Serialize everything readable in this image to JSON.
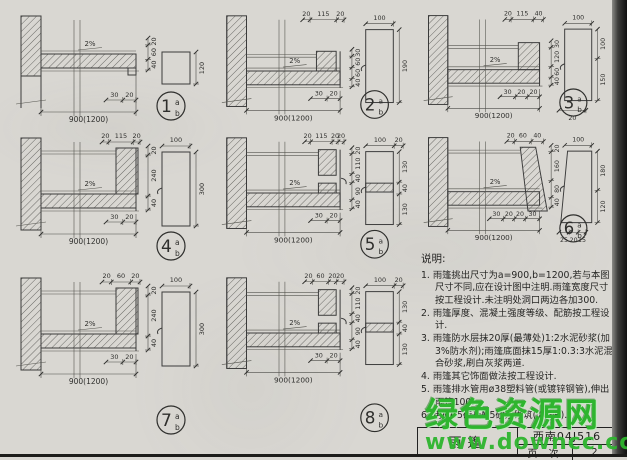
{
  "page": {
    "watermark": {
      "line1": "绿色资源网",
      "line2": "www.downcc.com",
      "color": "#2eb52e"
    },
    "title_block": {
      "drawing_title": "雨篷",
      "atlas_code": "西南04J516",
      "page_label": "页 次",
      "page_number": "2"
    }
  },
  "notes": {
    "heading": "说明:",
    "items": [
      {
        "text": "1. 雨篷挑出尺寸为a=900,b=1200,若与本图尺寸不同,应在设计图中注明.雨篷宽度尺寸按工程设计.未注明处洞口两边各加300."
      },
      {
        "text": "2. 雨篷厚度、混凝土强度等级、配筋按工程设计."
      },
      {
        "text": "3. 雨篷防水层抹20厚(最薄处)1:2水泥砂浆(加3%防水剂);雨篷底面抹15厚1:0.3:3水泥混合砂浆,刷白灰浆两道."
      },
      {
        "text": "4. 雨篷其它饰面做法按工程设计."
      },
      {
        "text": "5. 雨篷排水管用ø38塑料管(或镀锌钢管),伸出雨篷100."
      },
      {
        "text": "6. 用MU5砖及M5砂浆砌筑(②~⑧)."
      }
    ]
  },
  "details": [
    {
      "num": "1",
      "sup": "a",
      "sub": "b",
      "variant": "flat",
      "slope": "2%",
      "span": "900(1200)",
      "top_dims": [],
      "right_dims": [
        "20",
        "60",
        "40"
      ],
      "bottom_dims": [
        "30",
        "20"
      ],
      "side": {
        "shape": "square",
        "top_dims": [],
        "right_dims": [
          "120"
        ],
        "bottom_dims": []
      }
    },
    {
      "num": "2",
      "sup": "a",
      "sub": "b",
      "variant": "low",
      "slope": "2%",
      "span": "900(1200)",
      "top_dims": [
        "20",
        "115",
        "20"
      ],
      "right_dims": [
        "30",
        "60",
        "60",
        "40"
      ],
      "bottom_dims": [
        "30",
        "20"
      ],
      "side": {
        "shape": "tall",
        "top_dims": [
          "100"
        ],
        "right_dims": [
          "190"
        ],
        "bottom_dims": []
      }
    },
    {
      "num": "3",
      "sup": "a",
      "sub": "b",
      "variant": "mid",
      "slope": "2%",
      "span": "900(1200)",
      "top_dims": [
        "20",
        "115",
        "40"
      ],
      "right_dims": [
        "30",
        "120",
        "60",
        "40"
      ],
      "bottom_dims": [
        "30",
        "20",
        "20"
      ],
      "side": {
        "shape": "step",
        "top_dims": [
          "100"
        ],
        "right_dims": [
          "100",
          "150"
        ],
        "bottom_dims": [
          "20"
        ]
      }
    },
    {
      "num": "4",
      "sup": "a",
      "sub": "b",
      "variant": "high",
      "slope": "2%",
      "span": "900(1200)",
      "top_dims": [
        "20",
        "115",
        "20"
      ],
      "right_dims": [
        "20",
        "240",
        "40"
      ],
      "bottom_dims": [
        "30",
        "20"
      ],
      "side": {
        "shape": "tall",
        "top_dims": [
          "100"
        ],
        "right_dims": [
          "300"
        ],
        "bottom_dims": []
      }
    },
    {
      "num": "5",
      "sup": "a",
      "sub": "b",
      "variant": "gap",
      "slope": "2%",
      "span": "900(1200)",
      "top_dims": [
        "20",
        "115",
        "20",
        "20"
      ],
      "right_dims": [
        "20",
        "110",
        "40",
        "90",
        "40"
      ],
      "bottom_dims": [
        "30",
        "20"
      ],
      "side": {
        "shape": "gap",
        "top_dims": [
          "100",
          "20"
        ],
        "right_dims": [
          "130",
          "40",
          "130"
        ],
        "bottom_dims": []
      }
    },
    {
      "num": "6",
      "sup": "a",
      "sub": "b",
      "variant": "slopeUp",
      "slope": "2%",
      "span": "900(1200)",
      "top_dims": [
        "20",
        "60",
        "40"
      ],
      "right_dims": [
        "20",
        "160",
        "80",
        "40"
      ],
      "bottom_dims": [
        "30",
        "20",
        "20",
        "30"
      ],
      "side": {
        "shape": "trap",
        "top_dims": [
          "100"
        ],
        "right_dims": [
          "180",
          "120"
        ],
        "bottom_dims": [
          "25",
          "20",
          "15"
        ]
      }
    },
    {
      "num": "7",
      "sup": "a",
      "sub": "b",
      "variant": "high",
      "slope": "2%",
      "span": "900(1200)",
      "top_dims": [
        "20",
        "60",
        "20"
      ],
      "right_dims": [
        "20",
        "240",
        "40"
      ],
      "bottom_dims": [
        "30",
        "20"
      ],
      "side": {
        "shape": "tall",
        "top_dims": [
          "100"
        ],
        "right_dims": [
          "300"
        ],
        "bottom_dims": []
      }
    },
    {
      "num": "8",
      "sup": "a",
      "sub": "b",
      "variant": "gap",
      "slope": "2%",
      "span": "900(1200)",
      "top_dims": [
        "20",
        "60",
        "20",
        "20"
      ],
      "right_dims": [
        "20",
        "110",
        "40",
        "90",
        "40"
      ],
      "bottom_dims": [
        "30",
        "20"
      ],
      "side": {
        "shape": "gap",
        "top_dims": [
          "100",
          "20"
        ],
        "right_dims": [
          "130",
          "40",
          "130"
        ],
        "bottom_dims": []
      }
    }
  ]
}
